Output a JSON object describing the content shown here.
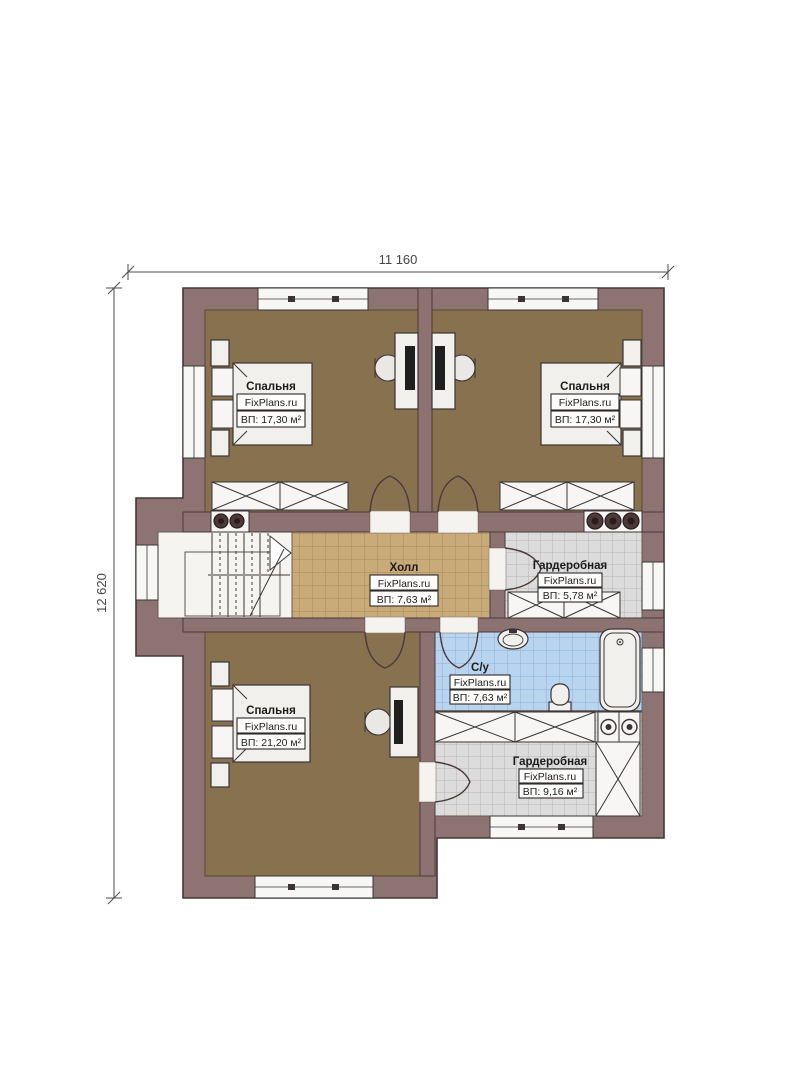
{
  "plan": {
    "type": "floor-plan",
    "brand": "FixPlans.ru"
  },
  "dimensions": {
    "width_label": "11 160",
    "height_label": "12 620"
  },
  "rooms": [
    {
      "id": "bedroom-top-left",
      "name": "Спальня",
      "brand": "FixPlans.ru",
      "area": "ВП: 17,30 м²"
    },
    {
      "id": "bedroom-top-right",
      "name": "Спальня",
      "brand": "FixPlans.ru",
      "area": "ВП: 17,30 м²"
    },
    {
      "id": "hall",
      "name": "Холл",
      "brand": "FixPlans.ru",
      "area": "ВП: 7,63 м²"
    },
    {
      "id": "wardrobe-upper",
      "name": "Гардеробная",
      "brand": "FixPlans.ru",
      "area": "ВП: 5,78 м²"
    },
    {
      "id": "bathroom",
      "name": "С/у",
      "brand": "FixPlans.ru",
      "area": "ВП: 7,63 м²"
    },
    {
      "id": "bedroom-bottom",
      "name": "Спальня",
      "brand": "FixPlans.ru",
      "area": "ВП: 21,20 м²"
    },
    {
      "id": "wardrobe-lower",
      "name": "Гардеробная",
      "brand": "FixPlans.ru",
      "area": "ВП: 9,16 м²"
    }
  ],
  "palette": {
    "wall": "#8e7373",
    "wall_stroke": "#463636",
    "bedroom_floor": "#87714f",
    "hall_floor": "#c9aa79",
    "hall_grid": "#a5885e",
    "wardrobe_floor": "#dcdcdc",
    "wardrobe_grid": "#b5b5b5",
    "bath_floor": "#b9d4ee",
    "bath_grid": "#8ab0d8",
    "fixture_fill": "#f1f0ed",
    "line_dark": "#3a3434"
  }
}
